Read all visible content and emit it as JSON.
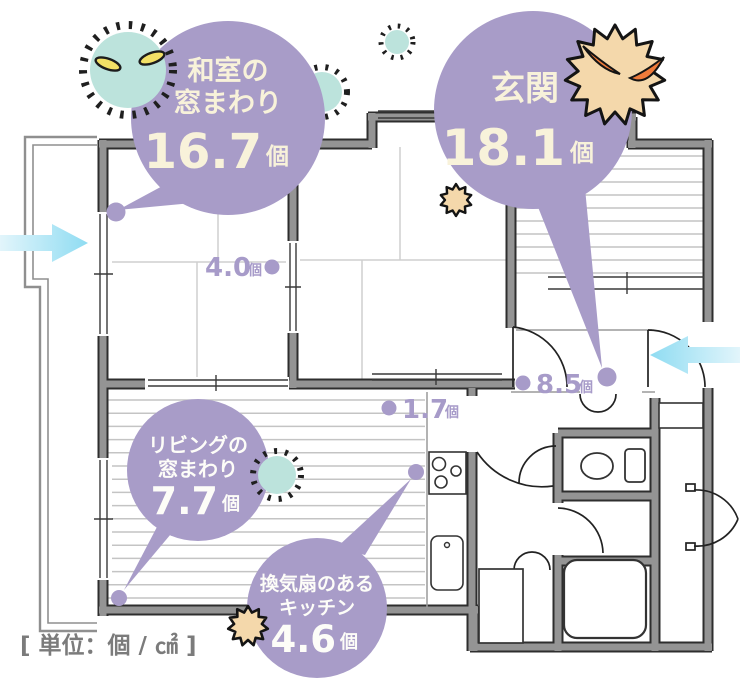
{
  "title": "室内のカビ数 間取り図",
  "unit_note": "[ 単位：個 / ㎠ ]",
  "bubbles": {
    "washitsu_window": {
      "label_line1": "和室の",
      "label_line2": "窓まわり",
      "value": "16.7",
      "unit": "個"
    },
    "genkan": {
      "label_line1": "玄関",
      "value": "18.1",
      "unit": "個"
    },
    "living_window": {
      "label_line1": "リビングの",
      "label_line2": "窓まわり",
      "value": "7.7",
      "unit": "個"
    },
    "kitchen_fan": {
      "label_line1": "換気扇のある",
      "label_line2": "キッチン",
      "value": "4.6",
      "unit": "個"
    }
  },
  "spot_labels": {
    "between_tatami_rooms": {
      "value": "4.0",
      "unit": "個"
    },
    "hallway_left": {
      "value": "1.7",
      "unit": "個"
    },
    "hallway_right": {
      "value": "8.5",
      "unit": "個"
    }
  },
  "icons": {
    "germs": [
      "teal-germ-large",
      "teal-germ-small",
      "teal-germ-tiny",
      "teal-germ-living",
      "orange-spiky-germ-large",
      "tan-spiky-germ-entrance",
      "tan-spiky-germ-kitchen"
    ],
    "arrows": [
      "airflow-arrow-left (points right, into window)",
      "airflow-arrow-right (points left, into entrance)"
    ]
  },
  "colors": {
    "bubble_purple": "#a89cc8",
    "bubble_text_cream": "#f8f2da",
    "bubble_text_white": "#fdfdf8",
    "spot_label_purple": "#a79bc9",
    "wall_gray": "#949494",
    "wall_edge": "#2e2e2e",
    "arrow_blue": "#8fdcf2",
    "germ_teal": "#bce3dc",
    "germ_tan": "#f4d8ab",
    "germ_eye_yellow": "#f2e066",
    "germ_eye_orange": "#ef7b3a",
    "unit_note_gray": "#7b7b7b"
  }
}
